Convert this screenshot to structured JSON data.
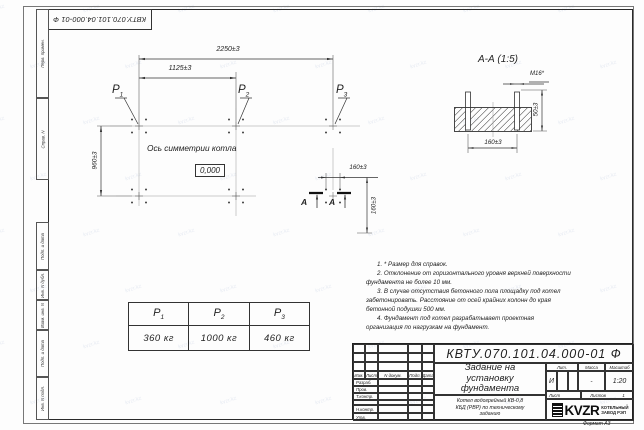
{
  "watermark": {
    "text": "kvzr.kz"
  },
  "stamp_top": "КВТУ.070.101.04.000-01 Ф",
  "side_strip": {
    "labels": [
      "Перв. примен.",
      "Справ. N",
      "Подп. и дата",
      "Инв. N дубл.",
      "Взам. инв. N",
      "Подп. и дата",
      "Инв. N подл."
    ]
  },
  "plan": {
    "dim_2250": "2250±3",
    "dim_1125": "1125±3",
    "dim_960": "960±3",
    "dim_160h": "160±3",
    "dim_160v": "160±3",
    "labels": [
      {
        "name": "P",
        "sub": "1"
      },
      {
        "name": "P",
        "sub": "2"
      },
      {
        "name": "P",
        "sub": "3"
      }
    ],
    "axis_label": "Ось симметрии котла",
    "elevation": "0,000",
    "section_letter": "А"
  },
  "section": {
    "title": "А-А (1:5)",
    "bolt_label": "М16*",
    "dim_width": "160±3",
    "dim_height": "50±3"
  },
  "loads_table": {
    "headers": [
      {
        "name": "P",
        "sub": "1"
      },
      {
        "name": "P",
        "sub": "2"
      },
      {
        "name": "P",
        "sub": "3"
      }
    ],
    "values": [
      "360 кг",
      "1000 кг",
      "460 кг"
    ]
  },
  "notes": [
    "1. * Размер для справок.",
    "2. Отклонение от горизонтального уровня верхней поверхности фундамента не более 10 мм.",
    "3. В случае отсутствия бетонного пола площадку под котел забетонировать. Расстояние от осей крайних колонн до края бетонной подушки 500 мм.",
    "4. Фундамент под котел разрабатывает проектная организация по нагрузкам на фундамент."
  ],
  "title_block": {
    "designation": "КВТУ.070.101.04.000-01 Ф",
    "doc_title": "Задание на установку фундамента",
    "product": "Котел водогрейный КВ-0,8 КБД (РВР) по техническому заданию",
    "header_cols": [
      "Изм.",
      "Лист",
      "N докум.",
      "Подп.",
      "Дата"
    ],
    "row_labels": [
      "Разраб.",
      "Пров.",
      "Т.контр.",
      "",
      "Н.контр.",
      "Утв."
    ],
    "lit_label": "Лит.",
    "lit_value": "И",
    "mass_label": "Масса",
    "mass_value": "-",
    "scale_label": "Масштаб",
    "scale_value": "1:20",
    "sheet_label": "Лист",
    "sheets_label": "Листов",
    "sheets_value": "1",
    "logo": "KVZR",
    "company_line1": "КОТЕЛЬНЫЙ",
    "company_line2": "ЗАВОД РЭП",
    "format": "Формат А3"
  }
}
